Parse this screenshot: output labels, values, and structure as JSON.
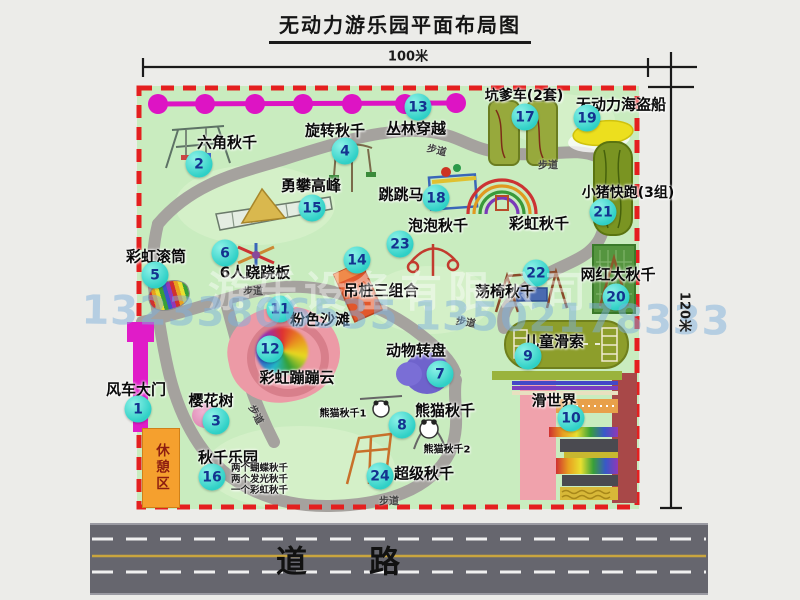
{
  "title": "无动力游乐园平面布局图",
  "labels": {
    "width": "100米",
    "height": "120米",
    "road": "道　　路",
    "trail": "步道",
    "rest_area": "休憩区"
  },
  "watermark": {
    "company": "游乐设备有限公司",
    "phone": "13233806535 13502178333"
  },
  "colors": {
    "park_green": "#c9ecbf",
    "border_red": "#e41f1f",
    "badge_cyan": "#2fd0c6",
    "magenta": "#dd14c4",
    "road_gray": "#66666e",
    "lane_yellow": "#c9a53e"
  },
  "attractions": [
    {
      "num": 1,
      "name": "风车大门",
      "bx": 138,
      "by": 409,
      "lx": 136,
      "ly": 389
    },
    {
      "num": 2,
      "name": "六角秋千",
      "bx": 199,
      "by": 164,
      "lx": 227,
      "ly": 142
    },
    {
      "num": 3,
      "name": "樱花树",
      "bx": 216,
      "by": 421,
      "lx": 211,
      "ly": 400
    },
    {
      "num": 4,
      "name": "旋转秋千",
      "bx": 345,
      "by": 151,
      "lx": 335,
      "ly": 130
    },
    {
      "num": 5,
      "name": "彩虹滚筒",
      "bx": 155,
      "by": 275,
      "lx": 156,
      "ly": 256
    },
    {
      "num": 6,
      "name": "6人跷跷板",
      "bx": 225,
      "by": 253,
      "lx": 255,
      "ly": 272
    },
    {
      "num": 7,
      "name": "动物转盘",
      "bx": 440,
      "by": 374,
      "lx": 416,
      "ly": 350
    },
    {
      "num": 8,
      "name": "熊猫秋千",
      "bx": 402,
      "by": 425,
      "lx": 445,
      "ly": 410
    },
    {
      "num": 9,
      "name": "儿童滑索",
      "bx": 528,
      "by": 356,
      "lx": 554,
      "ly": 341
    },
    {
      "num": 10,
      "name": "滑世界",
      "bx": 571,
      "by": 418,
      "lx": 554,
      "ly": 400
    },
    {
      "num": 11,
      "name": "粉色沙滩",
      "bx": 280,
      "by": 309,
      "lx": 320,
      "ly": 319
    },
    {
      "num": 12,
      "name": "彩虹蹦蹦云",
      "bx": 270,
      "by": 349,
      "lx": 297,
      "ly": 377
    },
    {
      "num": 13,
      "name": "丛林穿越",
      "bx": 418,
      "by": 107,
      "lx": 416,
      "ly": 128
    },
    {
      "num": 14,
      "name": "吊桩三组合",
      "bx": 357,
      "by": 260,
      "lx": 381,
      "ly": 290
    },
    {
      "num": 15,
      "name": "勇攀高峰",
      "bx": 312,
      "by": 208,
      "lx": 311,
      "ly": 185
    },
    {
      "num": 16,
      "name": "秋千乐园",
      "bx": 212,
      "by": 477,
      "lx": 228,
      "ly": 457
    },
    {
      "num": 17,
      "name": "坑爹车(2套)",
      "bx": 525,
      "by": 117,
      "lx": 524,
      "ly": 95,
      "fs": 14
    },
    {
      "num": 18,
      "name": "跳跳马",
      "bx": 436,
      "by": 198,
      "lx": 401,
      "ly": 194
    },
    {
      "num": 19,
      "name": "无动力海盗船",
      "bx": 587,
      "by": 118,
      "lx": 621,
      "ly": 104
    },
    {
      "num": 20,
      "name": "网红大秋千",
      "bx": 616,
      "by": 297,
      "lx": 618,
      "ly": 274
    },
    {
      "num": 21,
      "name": "小猪快跑(3组)",
      "bx": 603,
      "by": 212,
      "lx": 628,
      "ly": 192,
      "fs": 14
    },
    {
      "num": 22,
      "name": "荡椅秋千",
      "bx": 536,
      "by": 273,
      "lx": 505,
      "ly": 291
    },
    {
      "num": 23,
      "name": "泡泡秋千",
      "bx": 400,
      "by": 244,
      "lx": 438,
      "ly": 225
    },
    {
      "num": 24,
      "name": "超级秋千",
      "bx": 380,
      "by": 476,
      "lx": 424,
      "ly": 473
    }
  ],
  "extra_labels": [
    {
      "text": "彩虹秋千",
      "x": 539,
      "y": 223
    },
    {
      "text": "熊猫秋千1",
      "x": 343,
      "y": 412,
      "fs": 10
    },
    {
      "text": "熊猫秋千2",
      "x": 447,
      "y": 448,
      "fs": 10
    }
  ],
  "swing_notes": [
    "两个蝴蝶秋千",
    "两个发光秋千",
    "一个彩虹秋千"
  ],
  "trails": [
    {
      "x": 437,
      "y": 149,
      "rot": 14
    },
    {
      "x": 548,
      "y": 164,
      "rot": 0
    },
    {
      "x": 253,
      "y": 290,
      "rot": 0
    },
    {
      "x": 466,
      "y": 321,
      "rot": 10
    },
    {
      "x": 257,
      "y": 414,
      "rot": 62
    },
    {
      "x": 389,
      "y": 500,
      "rot": 0
    }
  ]
}
